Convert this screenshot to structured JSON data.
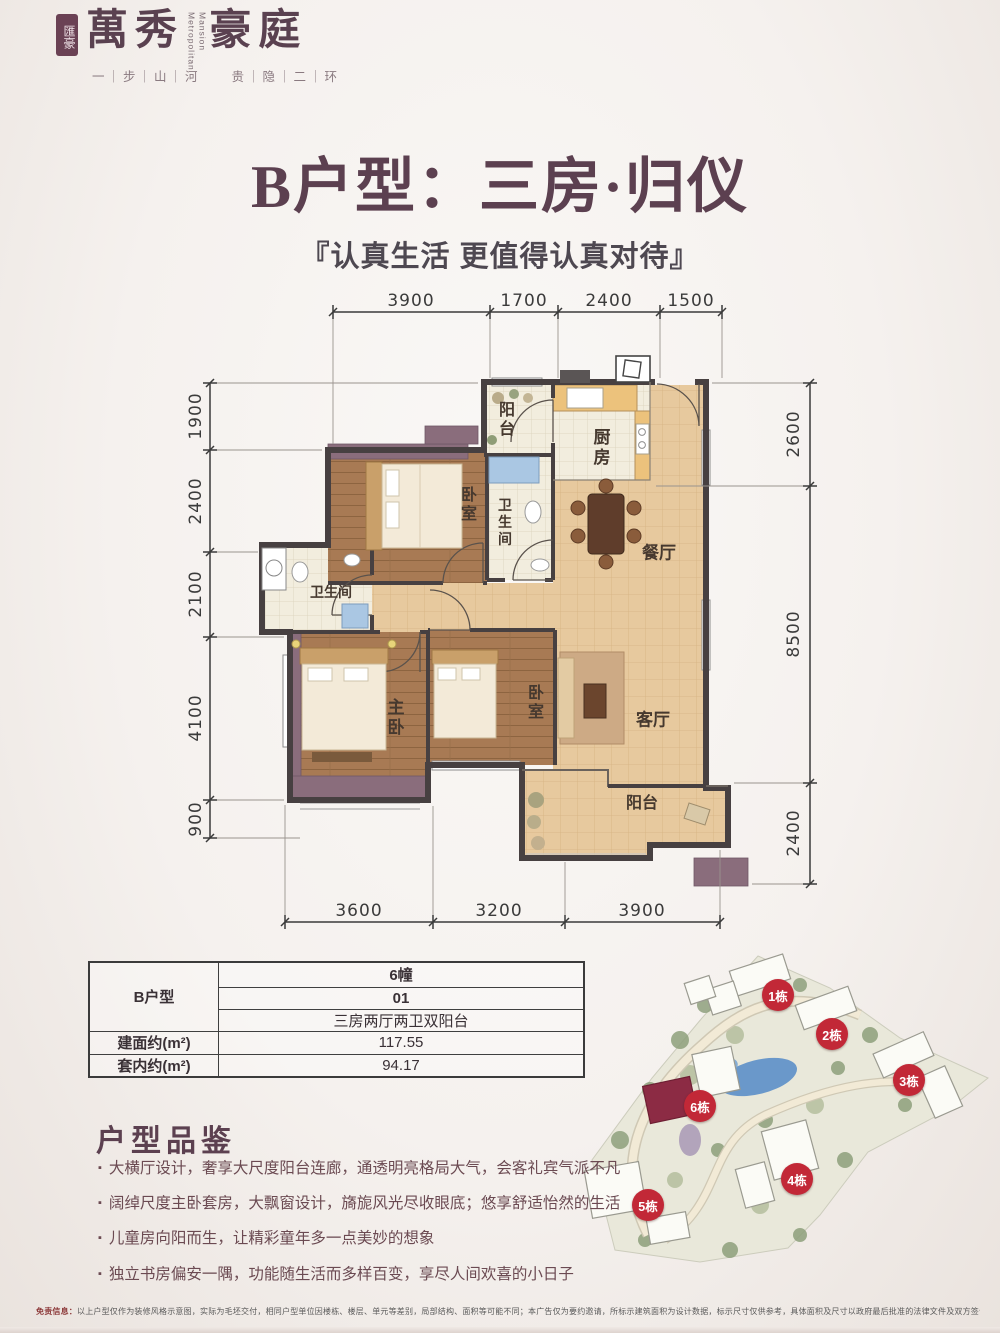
{
  "brand": {
    "seal": "匯豪",
    "name_cn_left": "萬秀",
    "name_cn_right": "豪庭",
    "name_en_line1": "Metropolitan",
    "name_en_line2": "Mansion",
    "tagline": "一｜步｜山｜河　　贵｜隐｜二｜环"
  },
  "headline": {
    "title": "B户型：三房·归仪",
    "subtitle": "『认真生活 更值得认真对待』"
  },
  "floorplan": {
    "dims_top": [
      "3900",
      "1700",
      "2400",
      "1500"
    ],
    "dims_bottom": [
      "3600",
      "3200",
      "3900"
    ],
    "dims_left": [
      "1900",
      "2400",
      "2100",
      "4100",
      "900"
    ],
    "dims_right": [
      "2600",
      "8500",
      "2400"
    ],
    "rooms": {
      "balcony_top": "阳台",
      "kitchen": "厨房",
      "bath_mid": "卫生间",
      "bedroom_top": "卧室",
      "dining": "餐厅",
      "bath_left": "卫生间",
      "master": "主卧",
      "bedroom_bottom": "卧室",
      "living": "客厅",
      "balcony_bottom": "阳台"
    }
  },
  "spec_table": {
    "unit_label": "B户型",
    "building": "6幢",
    "unit_no": "01",
    "layout": "三房两厅两卫双阳台",
    "gross_label": "建面约(m²)",
    "gross_value": "117.55",
    "net_label": "套内约(m²)",
    "net_value": "94.17"
  },
  "appreciation": {
    "heading": "户型品鉴",
    "bullet": "▪",
    "items": [
      "大横厅设计，奢享大尺度阳台连廊，通透明亮格局大气，会客礼宾气派不凡",
      "阔绰尺度主卧套房，大飘窗设计，旖旎风光尽收眼底；悠享舒适怡然的生活",
      "儿童房向阳而生，让精彩童年多一点美妙的想象",
      "独立书房偏安一隅，功能随生活而多样百变，享尽人间欢喜的小日子"
    ]
  },
  "siteplan": {
    "badges": [
      "1栋",
      "2栋",
      "3栋",
      "4栋",
      "5栋",
      "6栋"
    ]
  },
  "disclaimer": {
    "label": "免责信息：",
    "text": "以上户型仅作为装修风格示意图，实际为毛坯交付，相同户型单位因楼栋、楼层、单元等差别，局部结构、面积等可能不同；本广告仅为要约邀请，所标示建筑面积为设计数据，标示尺寸仅供参考，具体面积及尺寸以政府最后批准的法律文件及双方签订的买卖合同为准。"
  }
}
